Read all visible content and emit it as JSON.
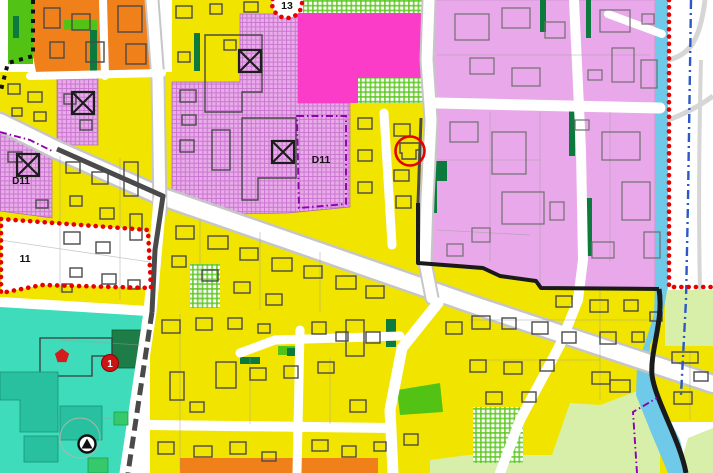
{
  "map": {
    "type": "zoning-plan",
    "labels": {
      "plan_area_13": "13",
      "district_d11_center": "D11",
      "district_d11_left": "D11",
      "plan_area_11": "11",
      "poi_badge_1": "1"
    },
    "icons": [
      "crossed-box-icon",
      "playground-icon",
      "red-pentagon-icon",
      "highlight-circle-icon",
      "badge-1-icon"
    ],
    "colors": {
      "yellow": "#F1E500",
      "orange": "#F08019",
      "magenta": "#FA3CC8",
      "hatch_base": "#E9ABE9",
      "hatch_line": "#C977CF",
      "purple_light": "#E9A8EA",
      "check_line": "#5BC61E",
      "bright_green": "#52C314",
      "dark_green": "#0B7A3C",
      "forest_green": "#1E7D46",
      "teal": "#3EDCBB",
      "teal_dark": "#28C09E",
      "teal_green": "#35C96B",
      "pale_green": "#D8EFA9",
      "river_blue": "#6FC9E9",
      "road_casing": "#C6C6C6",
      "road_dark_edge": "#4A4A4A",
      "boundary_black": "#1A1A1A",
      "building_stroke": "#4A4A4A",
      "parcel_line": "#9A9A9A",
      "red": "#E60000",
      "blue_line": "#2B59C8",
      "violet_line": "#9000B0",
      "white": "#FFFFFF"
    }
  }
}
